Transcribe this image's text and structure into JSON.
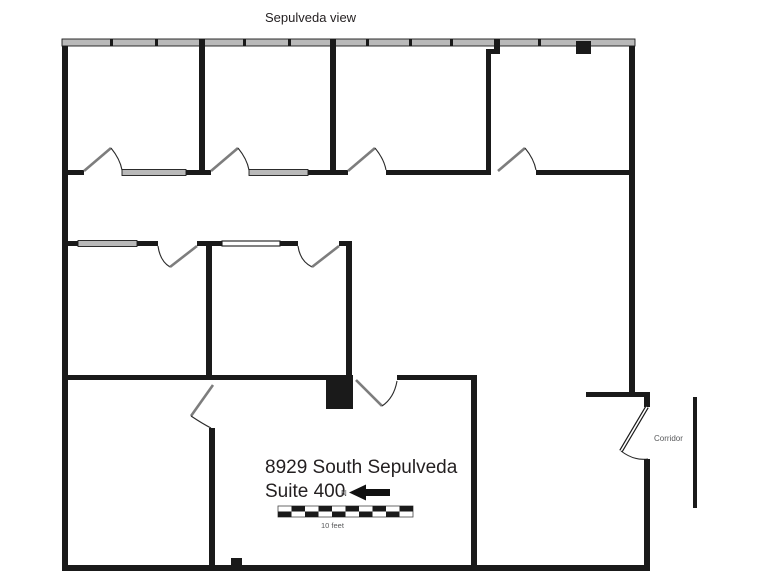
{
  "plan": {
    "top_label": "Sepulveda view",
    "address_line1": "8929 South Sepulveda",
    "address_line2": "Suite 400",
    "north_label": "N",
    "scale_label": "10 feet",
    "corridor_label": "Corridor"
  },
  "colors": {
    "wall": "#1a1a1a",
    "window_fill": "#b9b9b9",
    "door_leaf": "#7d7d7d",
    "text": "#231f20",
    "muted_text": "#58595b",
    "background": "#ffffff"
  }
}
